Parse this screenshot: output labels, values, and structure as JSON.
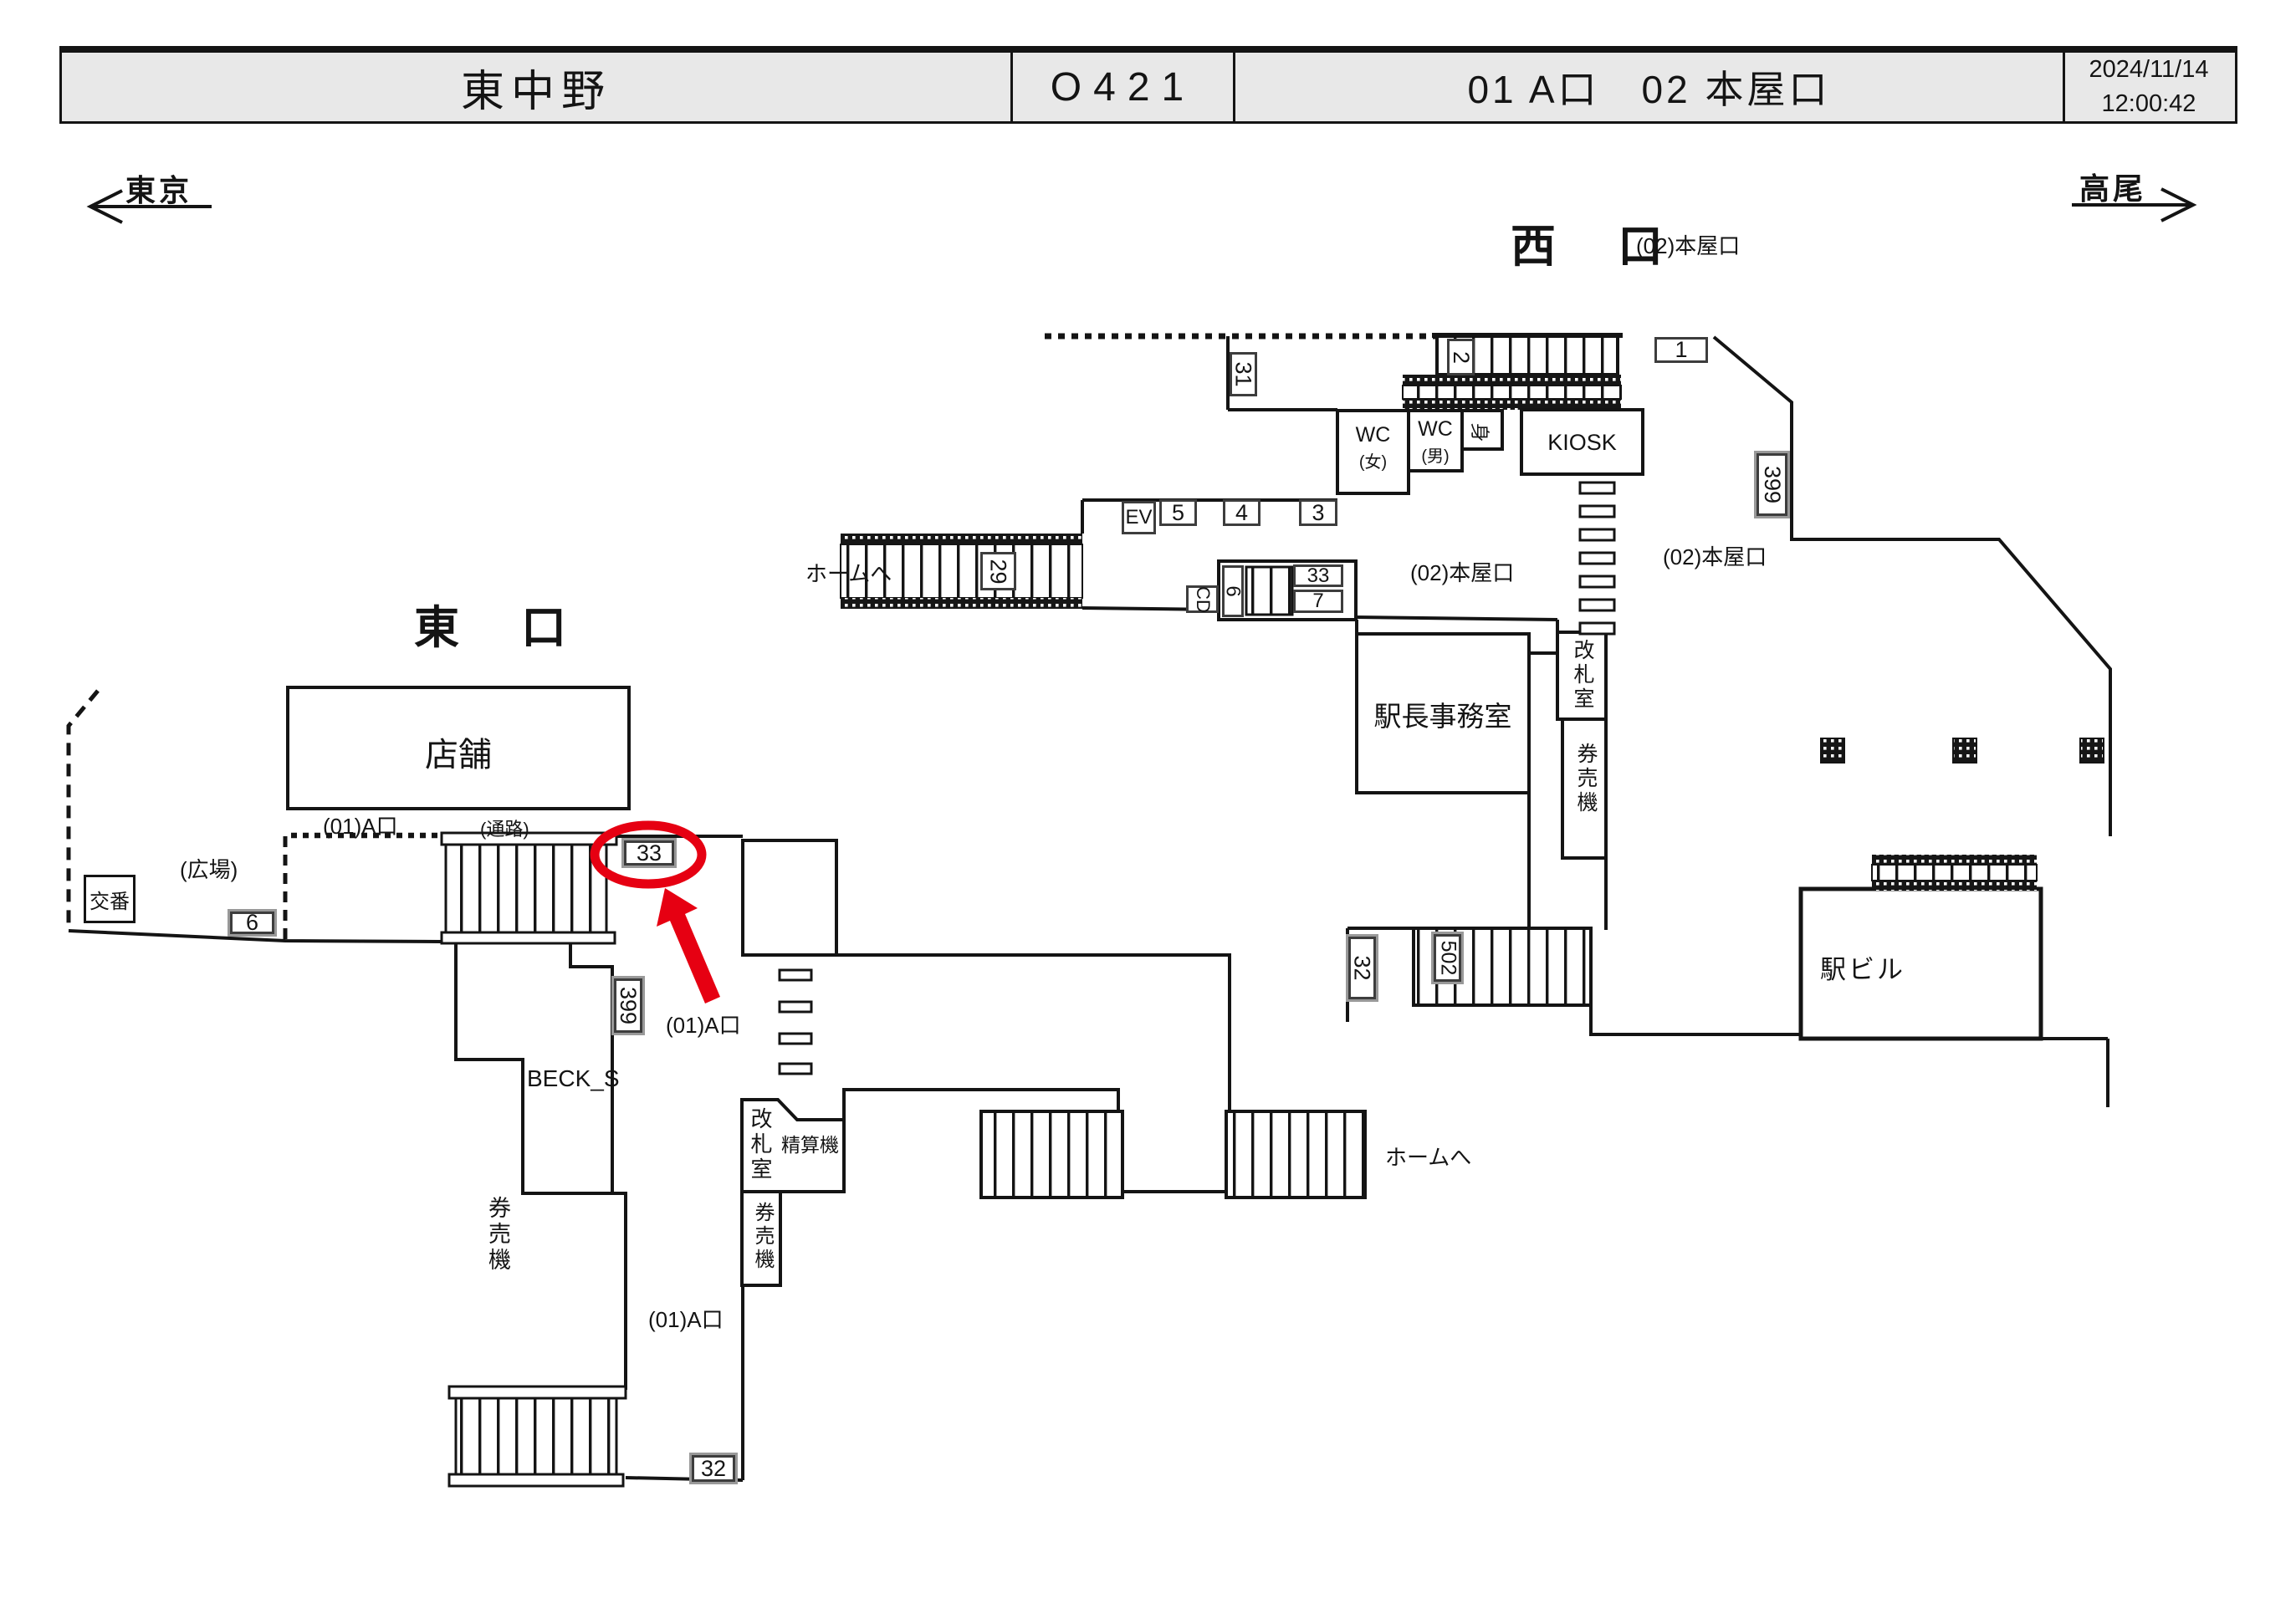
{
  "header": {
    "station": "東中野",
    "code": "O421",
    "exits": "01 A口　02 本屋口",
    "date": "2024/11/14",
    "time": "12:00:42"
  },
  "directions": {
    "left": "東京",
    "right": "高尾"
  },
  "labels": {
    "west_exit": "西　口",
    "east_exit": "東　口",
    "honya_exit": "(02)本屋口",
    "a_exit": "(01)A口",
    "shop": "店舗",
    "passage": "(通路)",
    "plaza": "(広場)",
    "koban": "交番",
    "beck": "BECK_S",
    "kenbaiki": "券売機",
    "kaisatsu": "改札室",
    "seisanki": "精算機",
    "to_platform": "ホームへ",
    "ekicho_office": "駅長事務室",
    "kiosk": "KIOSK",
    "wc": "WC",
    "wc_female": "(女)",
    "wc_male": "(男)",
    "mi": "身",
    "station_bldg": "駅ビル"
  },
  "boxes": {
    "n31": "31",
    "n2": "2",
    "n1": "1",
    "n399w": "399",
    "ev": "EV",
    "n5": "5",
    "n4": "4",
    "n3": "3",
    "n29": "29",
    "cd": "CD",
    "n6w": "6",
    "n33w": "33",
    "n7": "7",
    "n32w": "32",
    "n502": "502",
    "n6e": "6",
    "n33e": "33",
    "n399e": "399",
    "n32e": "32"
  },
  "highlight": {
    "circled_box": "33"
  },
  "colors": {
    "highlight_red": "#e60012",
    "header_bg": "#e8e8e8",
    "ink": "#141414",
    "box_border": "#3d3d3d"
  }
}
